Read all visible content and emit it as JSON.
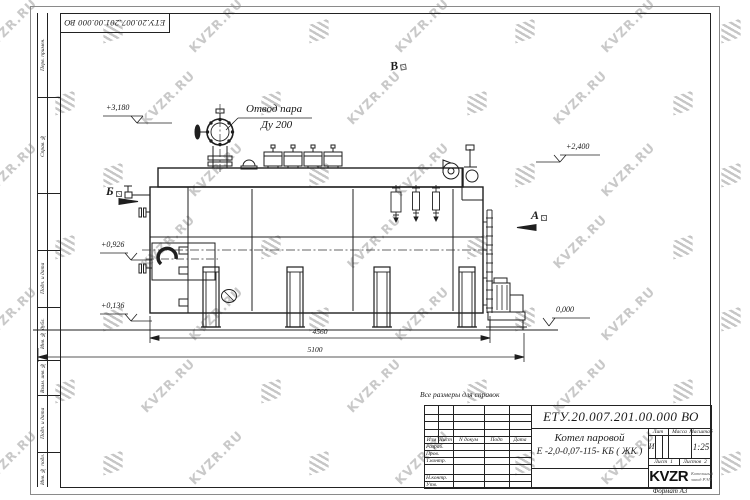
{
  "watermark": {
    "text": "KVZR.RU"
  },
  "sheet": {
    "top_stamp": "ЕТУ.20.007.201.00.000  ВО",
    "format_note": "Формат А3",
    "margin_top": [
      "Перв. примен.",
      "Справ. №"
    ],
    "margin_bottom": [
      "Подп. и дата",
      "Инв. № дубл.",
      "Взам. инв. №",
      "Подп. и дата",
      "Инв. № подл."
    ]
  },
  "drawing": {
    "note": "Все размеры для справок",
    "steam_outlet_label": "Отвод пара",
    "steam_outlet_size": "Ду 200",
    "dim_4560": "4560",
    "dim_5100": "5100",
    "elev_3180": "+3,180",
    "elev_2400": "+2,400",
    "elev_0926": "+0,926",
    "elev_0136": "+0,136",
    "elev_0000": "0,000",
    "view_b": "Б",
    "view_a": "А",
    "view_v": "В"
  },
  "title_block": {
    "designation": "ЕТУ.20.007.201.00.000  ВО",
    "product_line1": "Котел паровой",
    "product_line2": "Е -2,0-0,07-115- КБ ( ЖК )",
    "cols": {
      "izm": "Изм",
      "list": "Лист",
      "ndoc": "N докум",
      "podp": "Подп",
      "data": "Дата"
    },
    "rows": [
      "Разраб.",
      "Пров.",
      "Т.контр.",
      "Н.контр.",
      "Утв."
    ],
    "lit_label": "Лит",
    "lit_value": "И",
    "mass_label": "Масса",
    "scale_label": "Масштаб",
    "scale_value": "1:25",
    "sheet_label": "Лист",
    "sheet_no": "1",
    "sheets_label": "Листов",
    "sheets_total": "2",
    "logo": "KVZR",
    "logo_sub1": "Котельный",
    "logo_sub2": "завод РЭП"
  }
}
